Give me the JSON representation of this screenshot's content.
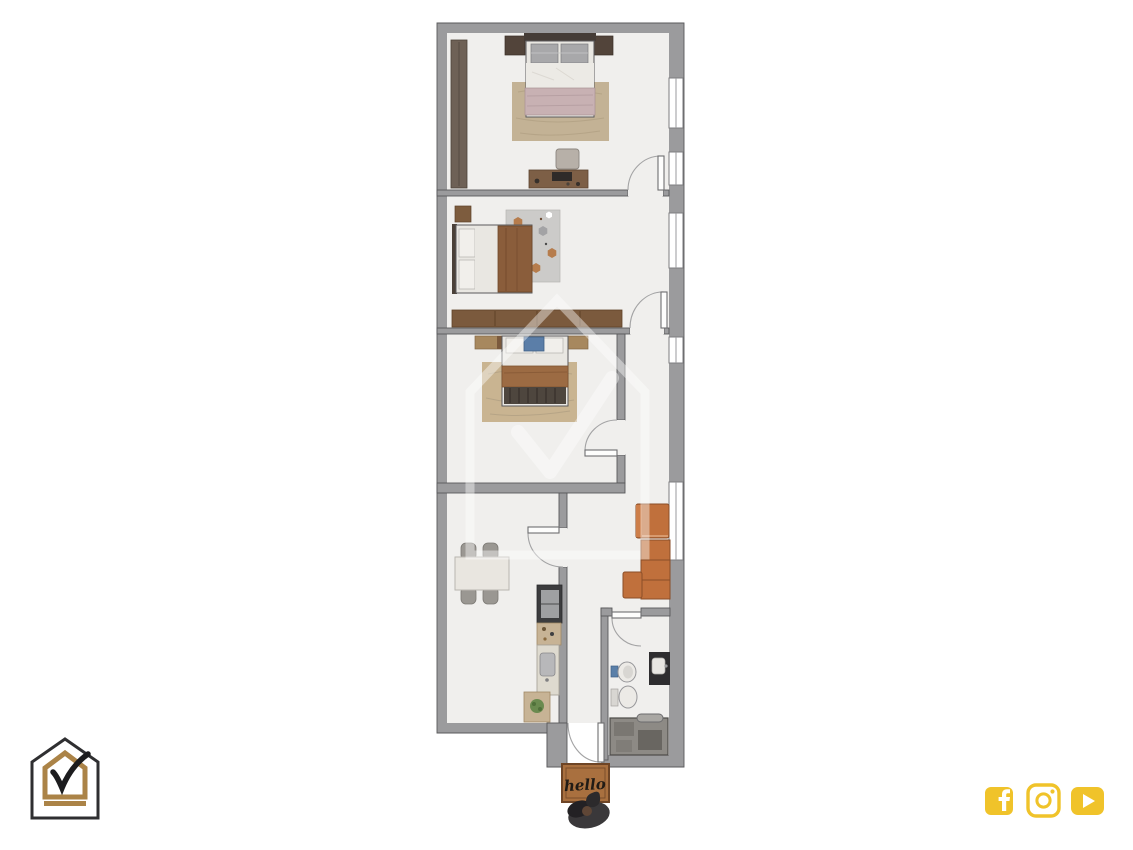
{
  "page": {
    "background_color": "#ffffff",
    "width": 1133,
    "height": 850
  },
  "floor_plan": {
    "type": "apartment-top-view-render",
    "doormat_text": "hello",
    "rooms": [
      {
        "id": "bedroom-top",
        "furniture": [
          "wardrobe",
          "double-bed",
          "nightstand-left",
          "nightstand-right",
          "rug",
          "desk",
          "desk-chair"
        ]
      },
      {
        "id": "bedroom-middle",
        "furniture": [
          "nightstand",
          "double-bed",
          "hexagon-rug",
          "wardrobe"
        ]
      },
      {
        "id": "bedroom-lower",
        "furniture": [
          "wardrobe",
          "single-bed",
          "wood-rug"
        ]
      },
      {
        "id": "kitchen-dining",
        "furniture": [
          "dining-table",
          "four-chairs",
          "fridge",
          "kitchen-counter",
          "sink",
          "plant"
        ]
      },
      {
        "id": "living-area",
        "furniture": [
          "corner-sofa",
          "ottoman"
        ]
      },
      {
        "id": "bathroom",
        "furniture": [
          "bidet",
          "toilet",
          "vanity-sink",
          "shower"
        ]
      },
      {
        "id": "entrance",
        "furniture": [
          "doormat",
          "boots"
        ]
      }
    ],
    "doors_count": 6,
    "windows_count": 5
  },
  "branding": {
    "logo_icon": "house-check-logo",
    "watermark_icon": "house-check-watermark"
  },
  "social_bar": {
    "icons": [
      {
        "name": "facebook-icon"
      },
      {
        "name": "instagram-icon"
      },
      {
        "name": "youtube-icon"
      }
    ]
  },
  "colors": {
    "wall": "#9b9b9d",
    "floor": "#f0efed",
    "wood": "#7b5a3d",
    "gold": "#ab8347",
    "ink": "#2f2f31",
    "social-yellow": "#f0c32a",
    "sofa": "#c0703c",
    "mat": "#a9703f"
  }
}
